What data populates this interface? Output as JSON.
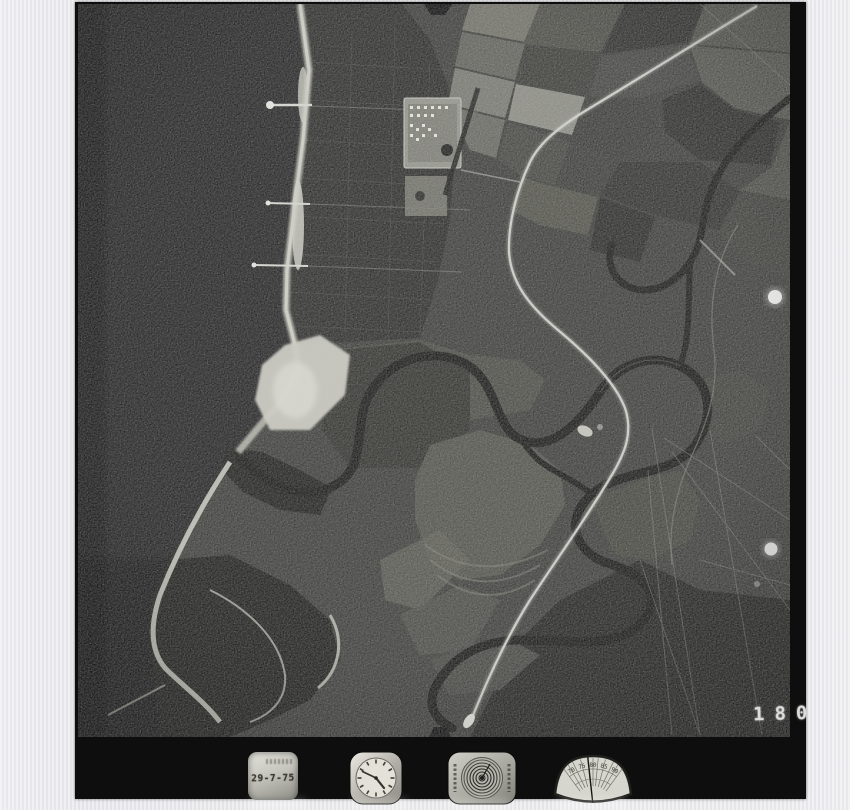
{
  "frame": {
    "number": "180"
  },
  "instruments": {
    "date_stamp": {
      "date": "29-7-75"
    },
    "clock": {
      "icon": "clock-dial"
    },
    "altimeter": {
      "icon": "altimeter-concentric-dial"
    },
    "level_gauge": {
      "icon": "fan-level-gauge",
      "scale_labels": [
        "70",
        "75",
        "80",
        "85",
        "90"
      ]
    }
  },
  "photo_features": [
    "ocean",
    "beach-coastline",
    "sand-spit",
    "dune-plantation-grid",
    "campground-compound",
    "piers",
    "field-mosaic",
    "meandering-river",
    "highway-road",
    "lagoon",
    "flare-dots",
    "fiducial-notches"
  ],
  "palette": {
    "scan_background": "#e9e9eb",
    "film_black": "#0e0e0e",
    "ocean": "#262626",
    "land": "#3b3b38",
    "beach": "#c2c2b8",
    "road": "#cfcfc7",
    "river": "#181816",
    "stamp_text": "#38382f",
    "frame_number_text": "#dedddb"
  }
}
